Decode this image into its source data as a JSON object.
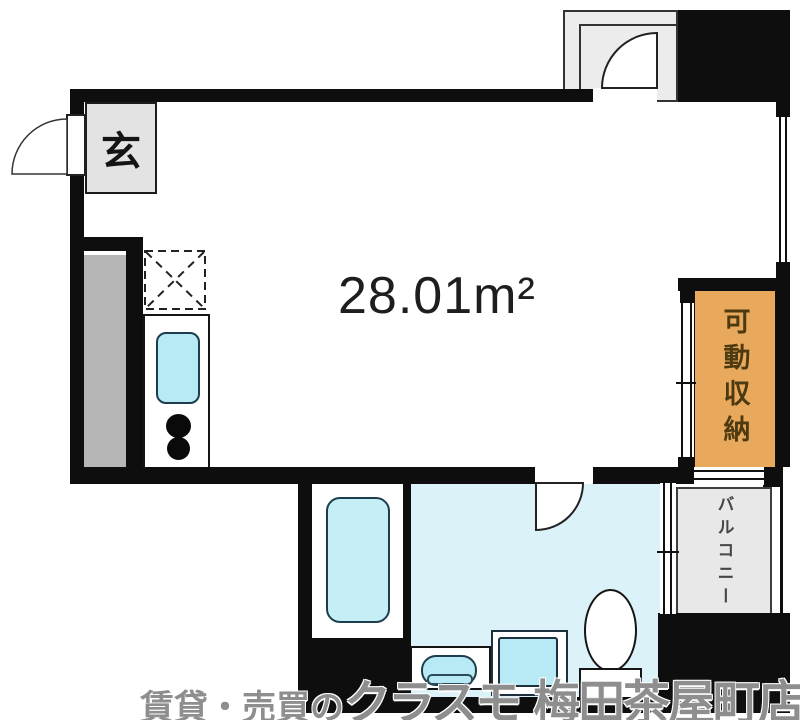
{
  "plan": {
    "area_label": "28.01m²",
    "entrance_label": "玄",
    "storage_label": "可動収納",
    "balcony_label": "バルコニー"
  },
  "watermark": {
    "prefix": "賃貸・売買の",
    "brand": "クラスモ",
    "store": "梅田茶屋町店"
  },
  "colors": {
    "wall_black": "#0e0e0e",
    "fixture_cyan": "#b7eaf4",
    "bathtub_cyan": "#c6eef7",
    "bath_floor_cyan": "#daf2f8",
    "storage_orange": "#e9a95c",
    "storage_text_brown": "#4d3a10",
    "duct_gray": "#b6b6b6",
    "balcony_gray": "#e8e8e8",
    "entrance_gray": "#e3e3e3",
    "door_alcove_gray": "#ececec",
    "watermark_gray": "#8e8e8e"
  }
}
